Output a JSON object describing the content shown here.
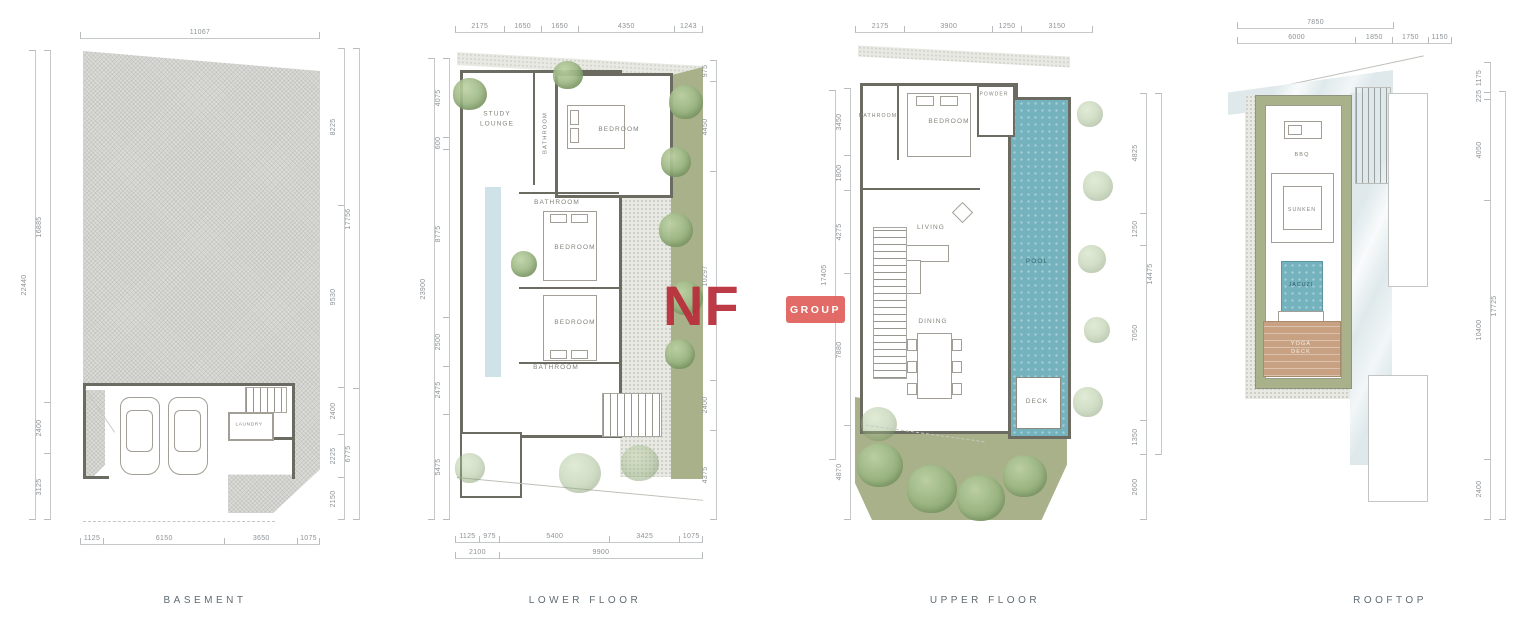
{
  "colors": {
    "brand": "#b92d3a",
    "watermark_box": "#e0605c",
    "pool": "#74b3be",
    "sage": "#a9b18b",
    "glass": "#dfe9ec",
    "wood": "#c8a183",
    "wall": "#6b6b62",
    "dimension": "#8d9296"
  },
  "watermark": {
    "brand": "NF",
    "suffix": "GROUP"
  },
  "floor_labels": {
    "basement": "BASEMENT",
    "lower": "LOWER FLOOR",
    "upper": "UPPER FLOOR",
    "rooftop": "ROOFTOP"
  },
  "basement": {
    "rooms": [
      "LAUNDRY"
    ],
    "dims": {
      "top": [
        "11067"
      ],
      "left_outer": [
        "22440"
      ],
      "left_inner": [
        "16885",
        "2400",
        "3125"
      ],
      "right_inner": [
        "8225",
        "9530",
        "2400",
        "2225",
        "2150"
      ],
      "right_outer": [
        "17756",
        "6775"
      ],
      "bottom": [
        "1125",
        "6150",
        "3650",
        "1075"
      ]
    }
  },
  "lower": {
    "rooms": [
      "STUDY LOUNGE",
      "BATHROOM",
      "BEDROOM",
      "BATHROOM",
      "BEDROOM",
      "BEDROOM",
      "BATHROOM"
    ],
    "dims": {
      "top": [
        "2175",
        "1650",
        "1650",
        "4350",
        "1243"
      ],
      "left_outer": [
        "23900"
      ],
      "left_inner": [
        "4075",
        "600",
        "8775",
        "2500",
        "2475",
        "5475"
      ],
      "right": [
        "975",
        "4450",
        "10297",
        "2400",
        "4375"
      ],
      "bottom_inner": [
        "1125",
        "975",
        "5400",
        "3425",
        "1075"
      ],
      "bottom_outer": [
        "2100",
        "9900"
      ]
    }
  },
  "upper": {
    "rooms": [
      "BATHROOM",
      "BEDROOM",
      "POWDER",
      "LIVING",
      "DINING",
      "POOL",
      "DECK"
    ],
    "dims": {
      "top": [
        "2175",
        "3900",
        "1250",
        "3150"
      ],
      "left_outer": [
        "17405"
      ],
      "left_inner": [
        "3450",
        "1800",
        "4275",
        "7880",
        "4870"
      ],
      "right_outer": [
        "14475"
      ],
      "right_inner": [
        "4825",
        "1250",
        "7050",
        "1350",
        "2600"
      ]
    }
  },
  "rooftop": {
    "rooms": [
      "BBQ",
      "SUNKEN",
      "JACUZI",
      "YOGA DECK"
    ],
    "dims": {
      "top_outer": [
        "7850"
      ],
      "top_inner": [
        "6000",
        "1850",
        "1750",
        "1150"
      ],
      "right_inner": [
        "1175",
        "225",
        "4050",
        "10400",
        "2400"
      ],
      "right_outer": [
        "17725"
      ]
    }
  }
}
